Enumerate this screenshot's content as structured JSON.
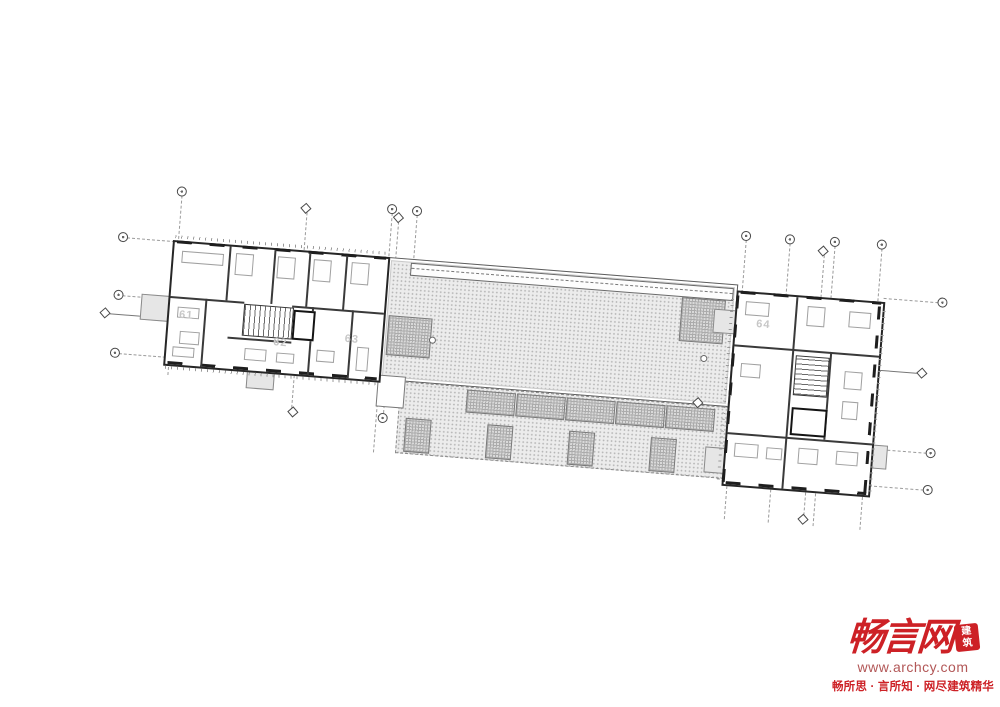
{
  "plan": {
    "units": {
      "u61": "61",
      "u62": "62",
      "u63": "63",
      "u64": "64"
    }
  },
  "watermark": {
    "logo_text": "畅言网",
    "seal_top": "建",
    "seal_bottom": "筑",
    "url": "www.archcy.com",
    "tagline": "畅所思 · 言所知 · 网尽建筑精华",
    "brand_red": "#cd2126",
    "url_red": "#b25757"
  }
}
